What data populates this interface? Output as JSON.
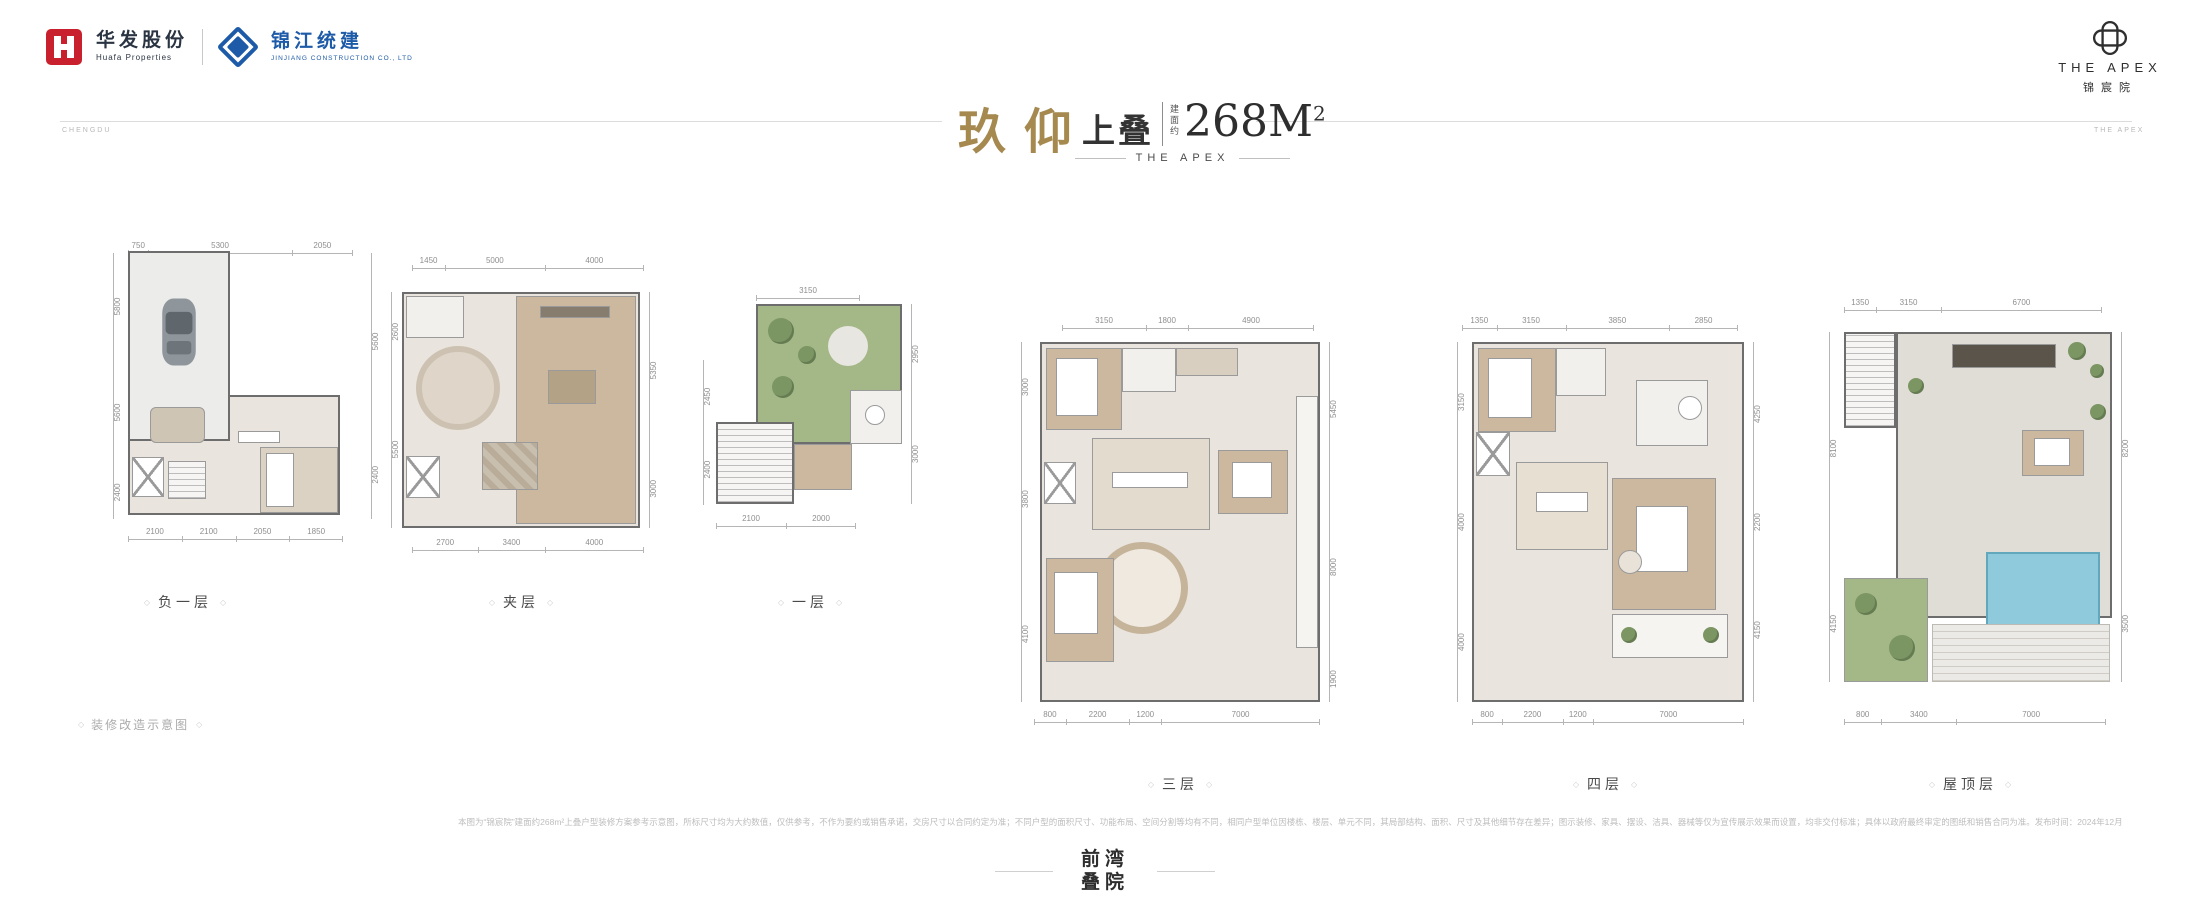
{
  "ornament": "◇",
  "header": {
    "huafa": {
      "name_cn": "华发股份",
      "name_en": "Huafa Properties"
    },
    "jinjiang": {
      "name_cn": "锦江统建",
      "name_en": "JINJIANG CONSTRUCTION CO., LTD"
    },
    "brand": {
      "en": "THE APEX",
      "cn": "锦宸院"
    }
  },
  "rule_labels": {
    "left": "CHENGDU",
    "right": "THE APEX"
  },
  "title": {
    "name": "玖仰",
    "type": "上叠",
    "area_prefix": "建面约",
    "area": "268M",
    "area_sup": "2",
    "subtitle": "THE APEX"
  },
  "plans": [
    {
      "label": "负一层",
      "dims_top": [
        "750",
        "5300",
        "2050"
      ],
      "dims_bottom": [
        "2100",
        "2100",
        "2050",
        "1850"
      ],
      "dims_left": [
        "5800",
        "5600",
        "2400"
      ],
      "dims_right": [
        "5600",
        "2400"
      ]
    },
    {
      "label": "夹层",
      "dims_top": [
        "1450",
        "5000",
        "4000"
      ],
      "dims_bottom": [
        "2700",
        "3400",
        "4000"
      ],
      "dims_left": [
        "2600",
        "5500"
      ],
      "dims_right": [
        "5350",
        "3000"
      ]
    },
    {
      "label": "一层",
      "dims_top": [
        "3150"
      ],
      "dims_bottom": [
        "2100",
        "2000"
      ],
      "dims_left": [
        "2450",
        "2400"
      ],
      "dims_right": [
        "2950",
        "3000"
      ]
    },
    {
      "label": "三层",
      "dims_top": [
        "3150",
        "1800",
        "4900"
      ],
      "dims_bottom": [
        "800",
        "2200",
        "1200",
        "7000"
      ],
      "dims_left": [
        "3000",
        "3800",
        "4100"
      ],
      "dims_right": [
        "5450",
        "8000",
        "1900"
      ]
    },
    {
      "label": "四层",
      "dims_top": [
        "1350",
        "3150",
        "3850",
        "2850"
      ],
      "dims_bottom": [
        "800",
        "2200",
        "1200",
        "7000"
      ],
      "dims_left": [
        "3150",
        "4000",
        "4000"
      ],
      "dims_right": [
        "4250",
        "2200",
        "4150"
      ]
    },
    {
      "label": "屋顶层",
      "dims_top": [
        "1350",
        "3150",
        "6700"
      ],
      "dims_bottom": [
        "800",
        "3400",
        "7000"
      ],
      "dims_left": [
        "8100",
        "4150"
      ],
      "dims_right": [
        "8200",
        "3500"
      ]
    }
  ],
  "footnote_label": "装修改造示意图",
  "disclaimer": "本图为“锦宸院”建面约268m²上叠户型装修方案参考示意图，所标尺寸均为大约数值，仅供参考，不作为要约或销售承诺，交房尺寸以合同约定为准；不同户型的面积尺寸、功能布局、空间分割等均有不同，相同户型单位因楼栋、楼层、单元不同，其局部结构、面积、尺寸及其他细节存在差异；图示装修、家具、摆设、洁具、器械等仅为宣传展示效果而设置，均非交付标准；具体以政府最终审定的图纸和销售合同为准。发布时间：2024年12月",
  "footer_logo": {
    "line1": "前湾",
    "line2": "叠院"
  }
}
